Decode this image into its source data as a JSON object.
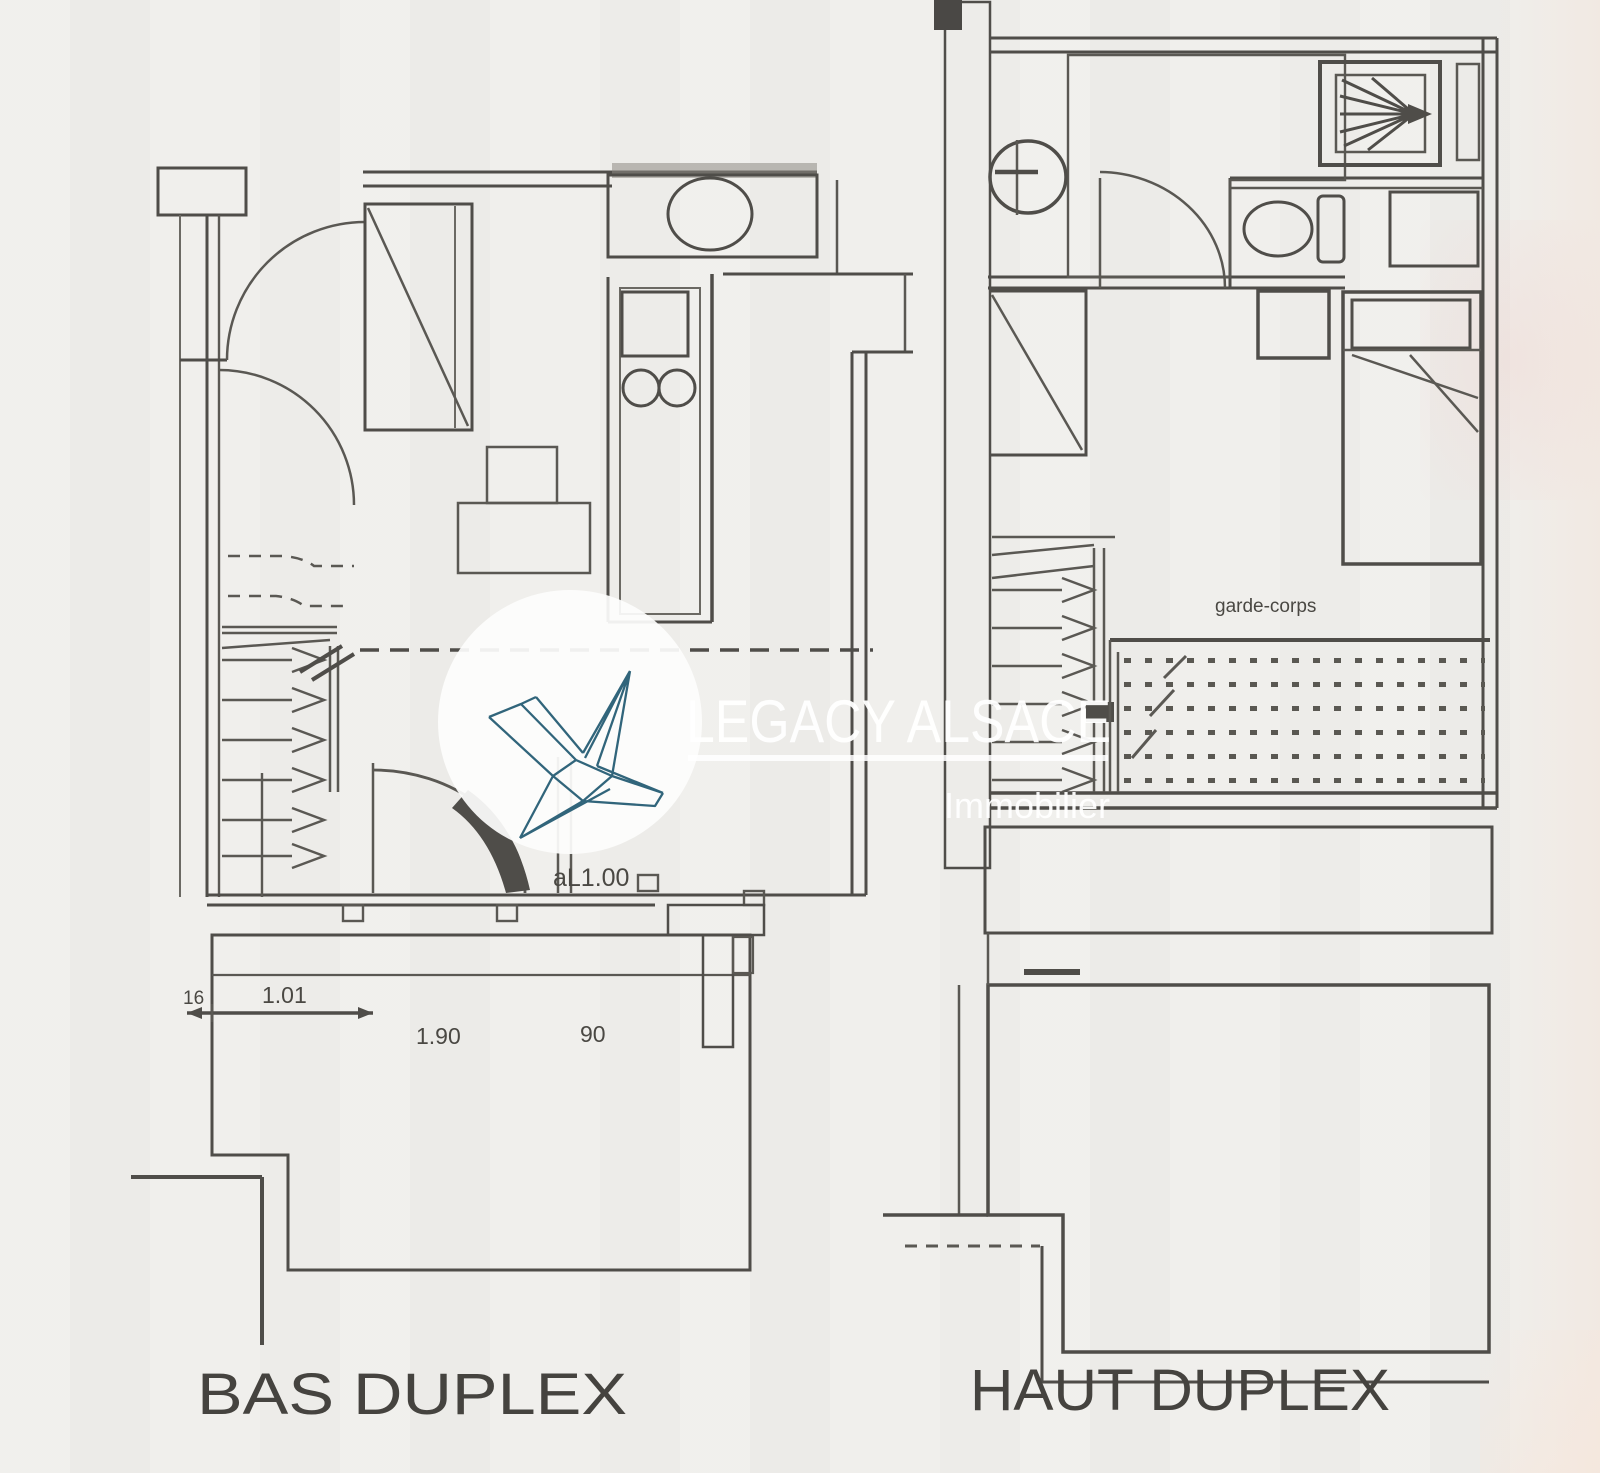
{
  "background_color": "#efeeeb",
  "line_color": "#4f4d49",
  "watermark": {
    "brand": "LEGACY ALSACE",
    "tagline": "Immobilier",
    "crane_color": "#31657b"
  },
  "plan_bas": {
    "title": "BAS DUPLEX",
    "sill_annotation": "aL1.00",
    "dimensions": {
      "d16": "16",
      "d101": "1.01",
      "d190": "1.90",
      "d90": "90"
    }
  },
  "plan_haut": {
    "title": "HAUT DUPLEX",
    "guardrail_label": "garde-corps"
  }
}
